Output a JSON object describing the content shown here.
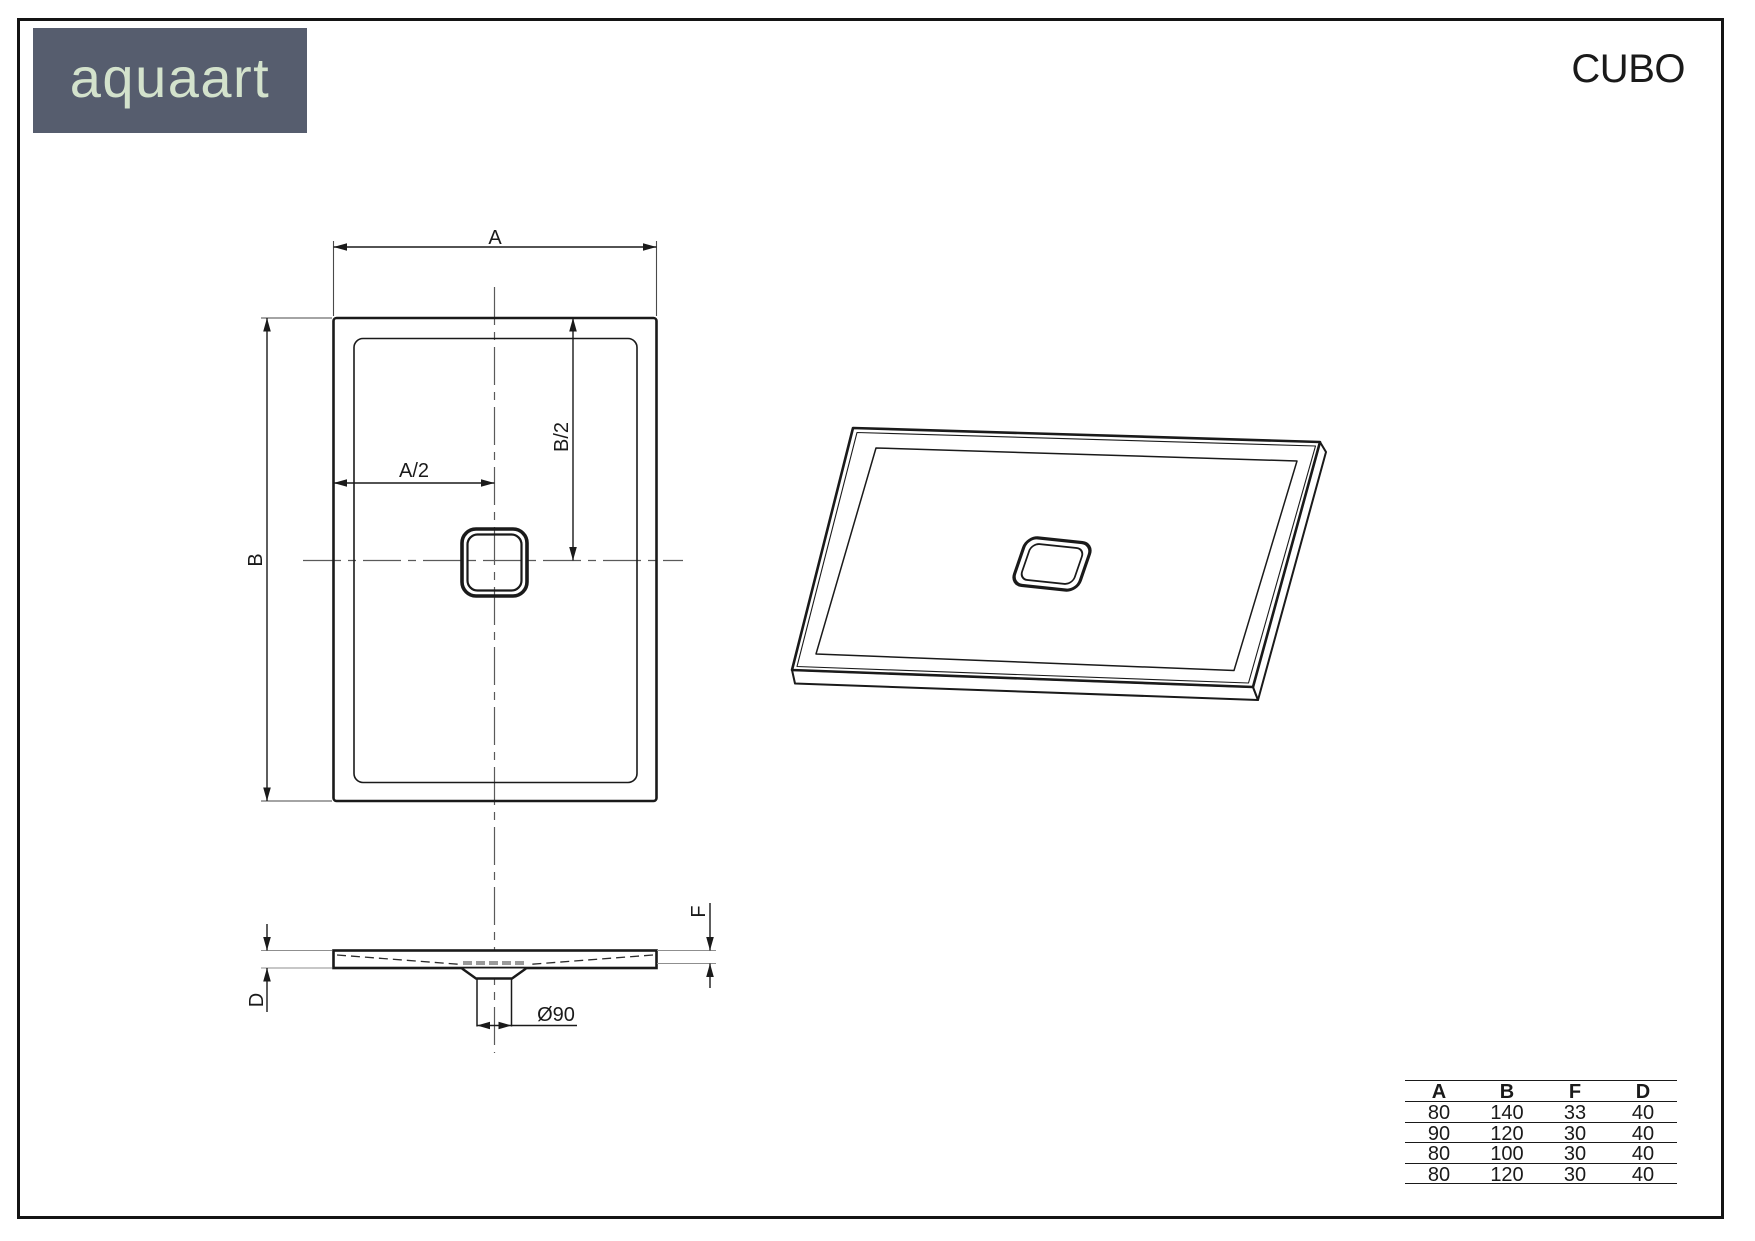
{
  "header": {
    "brand": "aquaart",
    "product_title": "CUBO",
    "logo_bg_color": "#565D6E",
    "logo_text_color": "#D3E2CC"
  },
  "drawing": {
    "line_color": "#1a1a1a",
    "aux_line_color": "#8f8f8f",
    "plan_view": {
      "labels": {
        "width": "A",
        "height": "B",
        "half_width": "A/2",
        "half_height": "B/2"
      }
    },
    "section_view": {
      "labels": {
        "total_depth": "D",
        "edge_height": "F",
        "drain_diameter": "Ø90"
      }
    }
  },
  "spec_table": {
    "columns": [
      "A",
      "B",
      "F",
      "D"
    ],
    "rows": [
      [
        "80",
        "140",
        "33",
        "40"
      ],
      [
        "90",
        "120",
        "30",
        "40"
      ],
      [
        "80",
        "100",
        "30",
        "40"
      ],
      [
        "80",
        "120",
        "30",
        "40"
      ]
    ]
  }
}
